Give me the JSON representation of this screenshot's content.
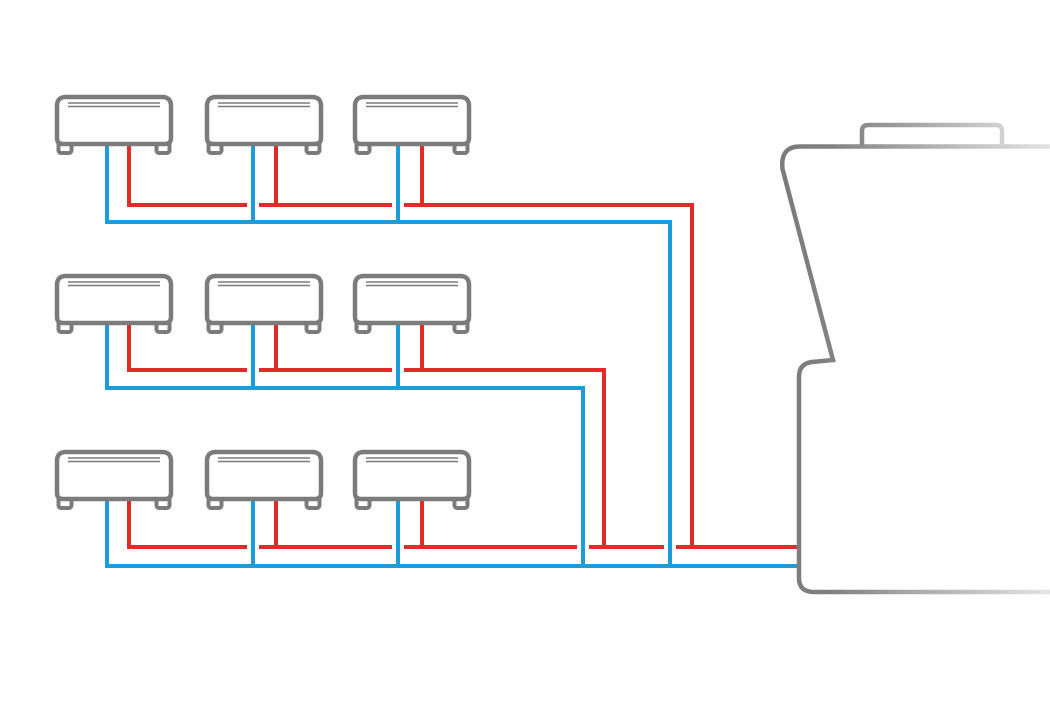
{
  "meta": {
    "background": "#ffffff",
    "canvas": {
      "width": 1050,
      "height": 720
    }
  },
  "diagram": {
    "kind": "vrf-hvac-piping-diagram",
    "description": "Nine indoor fan-coil units in three rows of three, connected by red (liquid) and blue (suction) refrigerant lines that merge into trunk lines entering a large outdoor unit partially visible at the right edge",
    "colors": {
      "red_line": "#E12B28",
      "blue_line": "#1A9DD9",
      "unit_gray": "#7B7B7B",
      "fade_gray_mid": "#B0B0B0",
      "fade_gray_light": "#E6E6E6",
      "fill": "#FFFFFF"
    },
    "stroke_widths": {
      "pipe": 4,
      "unit_outline": 4.5,
      "vent_line": 1.6,
      "outdoor_outline": 4.5
    },
    "indoor_units": {
      "count": 9,
      "grid": {
        "rows": 3,
        "cols": 3
      },
      "col_x": [
        57,
        207,
        355
      ],
      "row_y": [
        97,
        276,
        452
      ],
      "unit": {
        "width": 114,
        "height": 47,
        "body_path": "M9,0 L105,0 Q114,0 114,9 L114,41 Q114,47 108,47 L6,47 Q0,47 0,41 L0,9 Q0,0 9,0 Z",
        "vent_paths": [
          "M11,6 L103,6",
          "M11,9.5 L103,9.5"
        ],
        "feet": [
          {
            "x": 1.5,
            "y": 44,
            "w": 13,
            "h": 12,
            "rx": 2.5
          },
          {
            "x": 99.5,
            "y": 44,
            "w": 13,
            "h": 12,
            "rx": 2.5
          }
        ]
      }
    },
    "pipes": {
      "red": {
        "semantic": "liquid-line",
        "paths": [
          "M129,142 L129,205 L247,205",
          "M259,205 L392,205",
          "M404,205 L692,205 L692,549",
          "M276,142 L276,207",
          "M422,142 L422,207",
          "M129,321 L129,370 L247,370",
          "M259,370 L392,370",
          "M404,370 L604,370 L604,549",
          "M276,321 L276,372",
          "M422,321 L422,372",
          "M129,497 L129,547 L247,547",
          "M259,547 L392,547",
          "M404,547 L577,547",
          "M589,547 L664,547",
          "M676,547 L797,547",
          "M276,497 L276,549",
          "M422,497 L422,549"
        ]
      },
      "blue": {
        "semantic": "suction-line",
        "paths": [
          "M107,142 L107,222 L670,222 L670,568",
          "M253,142 L253,224",
          "M398,142 L398,224",
          "M107,321 L107,388 L583,388 L583,568",
          "M253,321 L253,390",
          "M398,321 L398,390",
          "M107,497 L107,566 L797,566",
          "M253,497 L253,568",
          "M398,497 L398,568"
        ]
      }
    },
    "outdoor_unit": {
      "body_path": "M1052,146.5 L800,146.5 Q780,146.5 782.5,169 L833,360 L812,362 Q799,363.5 799,377 L799,578 Q799,592 814,592 L1052,592",
      "top_panel_path": "M862,146 L862,131 Q862,125 868,125 L996,125 Q1002,125 1002,131 L1002,146",
      "body_gradient": {
        "x1": 778,
        "x2": 1056,
        "stops": [
          {
            "offset": 0,
            "color": "#7A7A7A"
          },
          {
            "offset": 0.2,
            "color": "#828282"
          },
          {
            "offset": 0.55,
            "color": "#B0B0B0"
          },
          {
            "offset": 1,
            "color": "#E6E6E6"
          }
        ]
      },
      "panel_gradient": {
        "x1": 858,
        "x2": 1012,
        "stops": [
          {
            "offset": 0,
            "color": "#898989"
          },
          {
            "offset": 1,
            "color": "#D6D6D6"
          }
        ]
      }
    }
  }
}
